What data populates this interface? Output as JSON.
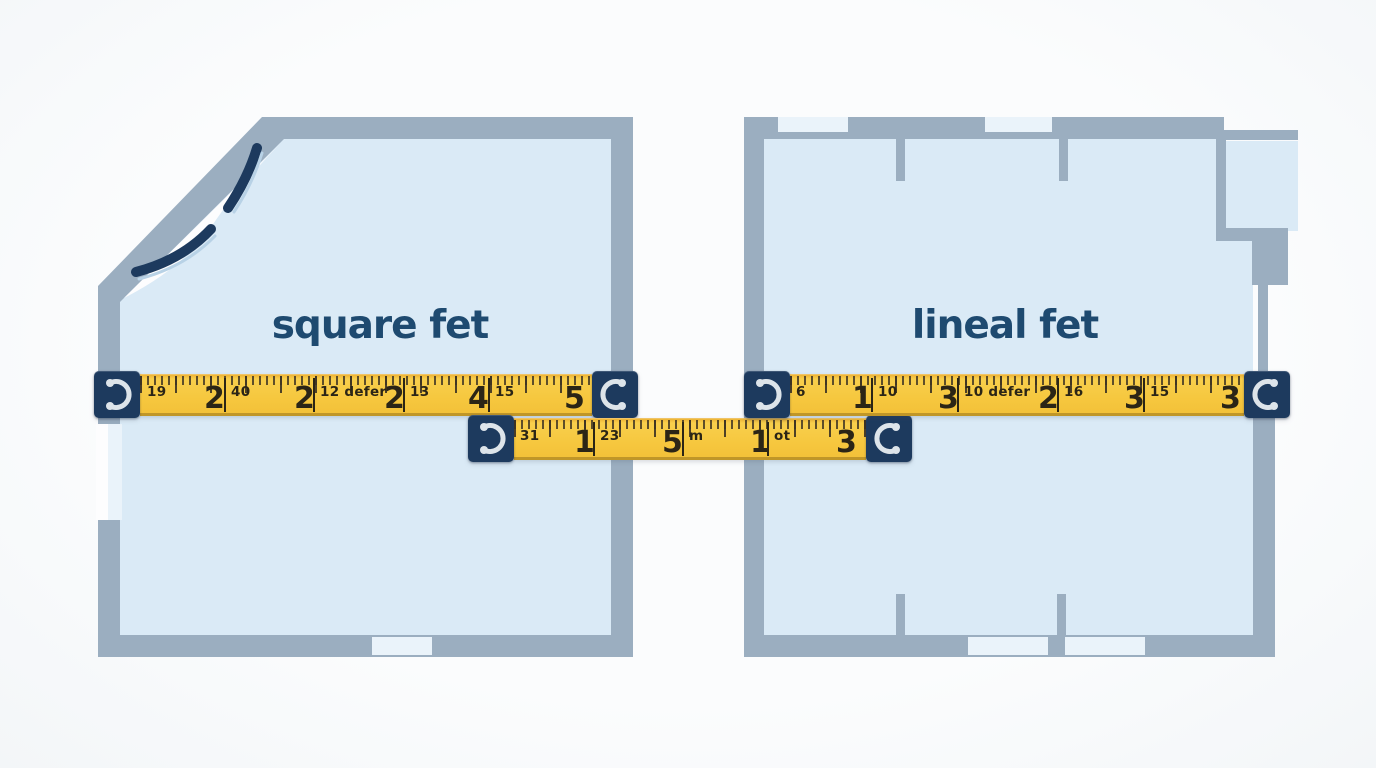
{
  "illustration": {
    "left_room_label": "square fet",
    "right_room_label": "lineal fet"
  },
  "colors": {
    "background": "#fbfcfd",
    "room_fill": "#daeaf6",
    "wall_gray": "#9baec0",
    "opening_light": "#eaf3fa",
    "door_gap_white": "#fdfdfe",
    "tape_yellow": "#f6c73e",
    "tape_cap_navy": "#1d3a5e",
    "tick_dark": "#3c3222",
    "number_dark": "#2b2516",
    "label_navy": "#1e4a70",
    "door_arc_navy": "#1d3a5e"
  },
  "tapes": [
    {
      "name": "left-tape",
      "marks": [
        {
          "t": "19",
          "k": "s",
          "x": 7,
          "sep": false
        },
        {
          "t": "2",
          "k": "b",
          "x": 64,
          "sep": false
        },
        {
          "t": "40",
          "k": "s",
          "x": 91,
          "sep": true
        },
        {
          "t": "2",
          "k": "b",
          "x": 154,
          "sep": false
        },
        {
          "t": "12 defer",
          "k": "s",
          "x": 180,
          "sep": true
        },
        {
          "t": "2",
          "k": "b",
          "x": 244,
          "sep": false
        },
        {
          "t": "13",
          "k": "s",
          "x": 270,
          "sep": true
        },
        {
          "t": "4",
          "k": "b",
          "x": 328,
          "sep": false
        },
        {
          "t": "15",
          "k": "s",
          "x": 355,
          "sep": true
        },
        {
          "t": "5",
          "k": "b",
          "x": 424,
          "sep": false
        }
      ]
    },
    {
      "name": "center-tape",
      "marks": [
        {
          "t": "31",
          "k": "s",
          "x": 6,
          "sep": false
        },
        {
          "t": "1",
          "k": "b",
          "x": 60,
          "sep": false
        },
        {
          "t": "23",
          "k": "s",
          "x": 86,
          "sep": true
        },
        {
          "t": "5",
          "k": "b",
          "x": 148,
          "sep": false
        },
        {
          "t": "m",
          "k": "s",
          "x": 175,
          "sep": true
        },
        {
          "t": "1",
          "k": "b",
          "x": 236,
          "sep": false
        },
        {
          "t": "ot",
          "k": "s",
          "x": 260,
          "sep": true
        },
        {
          "t": "3",
          "k": "b",
          "x": 322,
          "sep": false
        }
      ]
    },
    {
      "name": "right-tape",
      "marks": [
        {
          "t": "6",
          "k": "s",
          "x": 6,
          "sep": false
        },
        {
          "t": "1",
          "k": "b",
          "x": 62,
          "sep": false
        },
        {
          "t": "10",
          "k": "s",
          "x": 88,
          "sep": true
        },
        {
          "t": "3",
          "k": "b",
          "x": 148,
          "sep": false
        },
        {
          "t": "10 defer",
          "k": "s",
          "x": 174,
          "sep": true
        },
        {
          "t": "2",
          "k": "b",
          "x": 248,
          "sep": false
        },
        {
          "t": "16",
          "k": "s",
          "x": 274,
          "sep": true
        },
        {
          "t": "3",
          "k": "b",
          "x": 334,
          "sep": false
        },
        {
          "t": "15",
          "k": "s",
          "x": 360,
          "sep": true
        },
        {
          "t": "3",
          "k": "b",
          "x": 430,
          "sep": false
        }
      ]
    }
  ]
}
